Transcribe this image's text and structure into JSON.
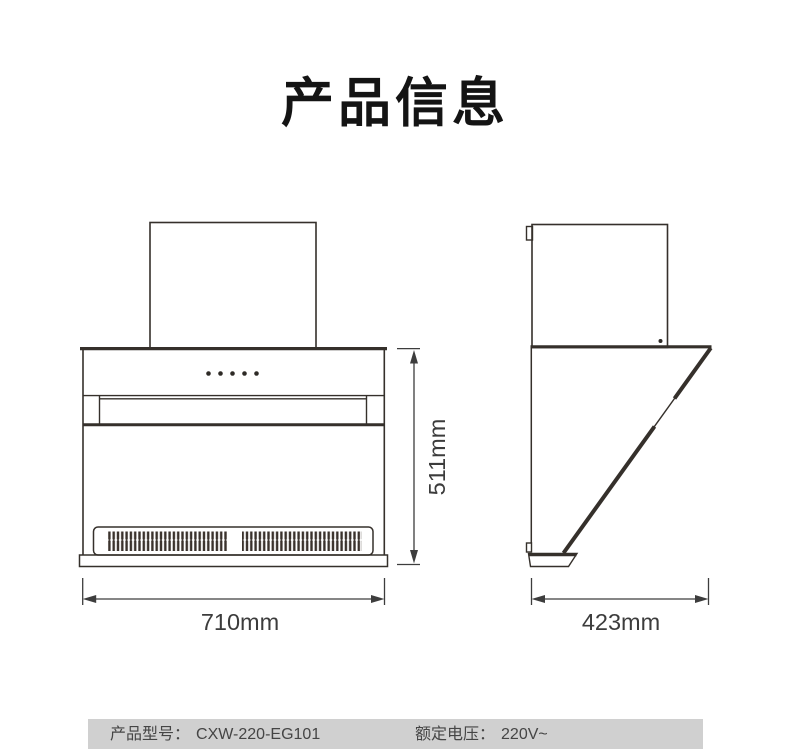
{
  "title": "产品信息",
  "colors": {
    "line": "#35302b",
    "dimension": "#3d3d3d",
    "spec_bar_bg": "#d0d0d0",
    "title_text": "#141414"
  },
  "front_view": {
    "width_label": "710mm",
    "height_label": "511mm"
  },
  "side_view": {
    "depth_label": "423mm"
  },
  "spec_bar": {
    "model_label": "产品型号：",
    "model_value": "CXW-220-EG101",
    "voltage_label": "额定电压：",
    "voltage_value": "220V~"
  }
}
